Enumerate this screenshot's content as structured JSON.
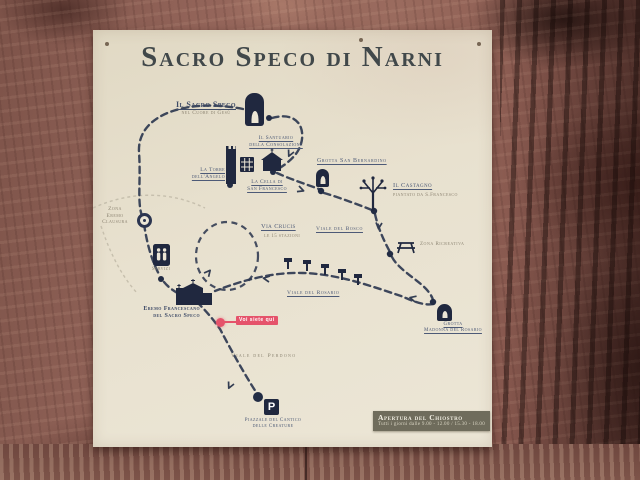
{
  "sign": {
    "title": "Sacro Speco di Narni",
    "pois": {
      "sacro_speco": {
        "label": "Il Sacro Speco",
        "sublabel": "nel Cuore di Gesù"
      },
      "santuario": {
        "line1": "Il Santuario",
        "line2": "della Consolazione"
      },
      "torre": {
        "line1": "La Torre",
        "line2": "dell'Angelo"
      },
      "cella": {
        "line1": "La Cella di",
        "line2": "San Francesco"
      },
      "bernardino": {
        "label": "Grotta San Bernardino"
      },
      "castagno": {
        "label": "Il Castagno",
        "sublabel": "piantato da S.Francesco"
      },
      "zona_eremo": {
        "line1": "Zona",
        "line2": "Eremo",
        "line3": "Clausura"
      },
      "via_crucis": {
        "label": "Via Crucis",
        "sublabel": "le 15 stazioni"
      },
      "viale_bosco": {
        "label": "Viale del Bosco"
      },
      "zona_ricreativa": {
        "label": "Zona Ricreativa"
      },
      "servizi": {
        "label": "Servizi"
      },
      "eremo": {
        "line1": "Eremo Francescano",
        "line2": "del Sacro Speco"
      },
      "you_are_here": {
        "label": "Voi siete qui"
      },
      "viale_rosario": {
        "label": "Viale del Rosario"
      },
      "grotta_rosario": {
        "line1": "Grotta",
        "line2": "Madonna del Rosario"
      },
      "viale_perdono": {
        "label": "Viale del Perdono"
      },
      "piazzale": {
        "line1": "Piazzale del Cantico",
        "line2": "delle Creature"
      },
      "parking": {
        "letter": "P"
      }
    },
    "opening": {
      "title": "Apertura del Chiostro",
      "hours": "Tutti i giorni dalle 9.00 - 12.00 / 15.30 - 18.00"
    },
    "icons": {
      "sacro_speco": "grotto-arch-icon",
      "torre": "tower-icon",
      "cloister": "cloister-grid-icon",
      "santuario": "church-icon",
      "bernardino": "grotto-arch-icon",
      "castagno": "tree-icon",
      "zona_eremo": "ring-icon",
      "zona_ricreativa": "picnic-table-icon",
      "servizi": "restroom-icon",
      "eremo": "monastery-icon",
      "grotta_rosario": "bell-grotto-icon",
      "parking": "parking-icon",
      "you_are_here": "red-dot-marker"
    },
    "colors": {
      "panel": "#e7e0cd",
      "ink": "#4d5a77",
      "ink_dark": "#3d4a66",
      "ink_soft": "#8d8573",
      "icon_navy": "#20283f",
      "accent_red": "#e5536b",
      "box_olive": "#6f6c5c",
      "wood": "#8a5a50"
    }
  }
}
